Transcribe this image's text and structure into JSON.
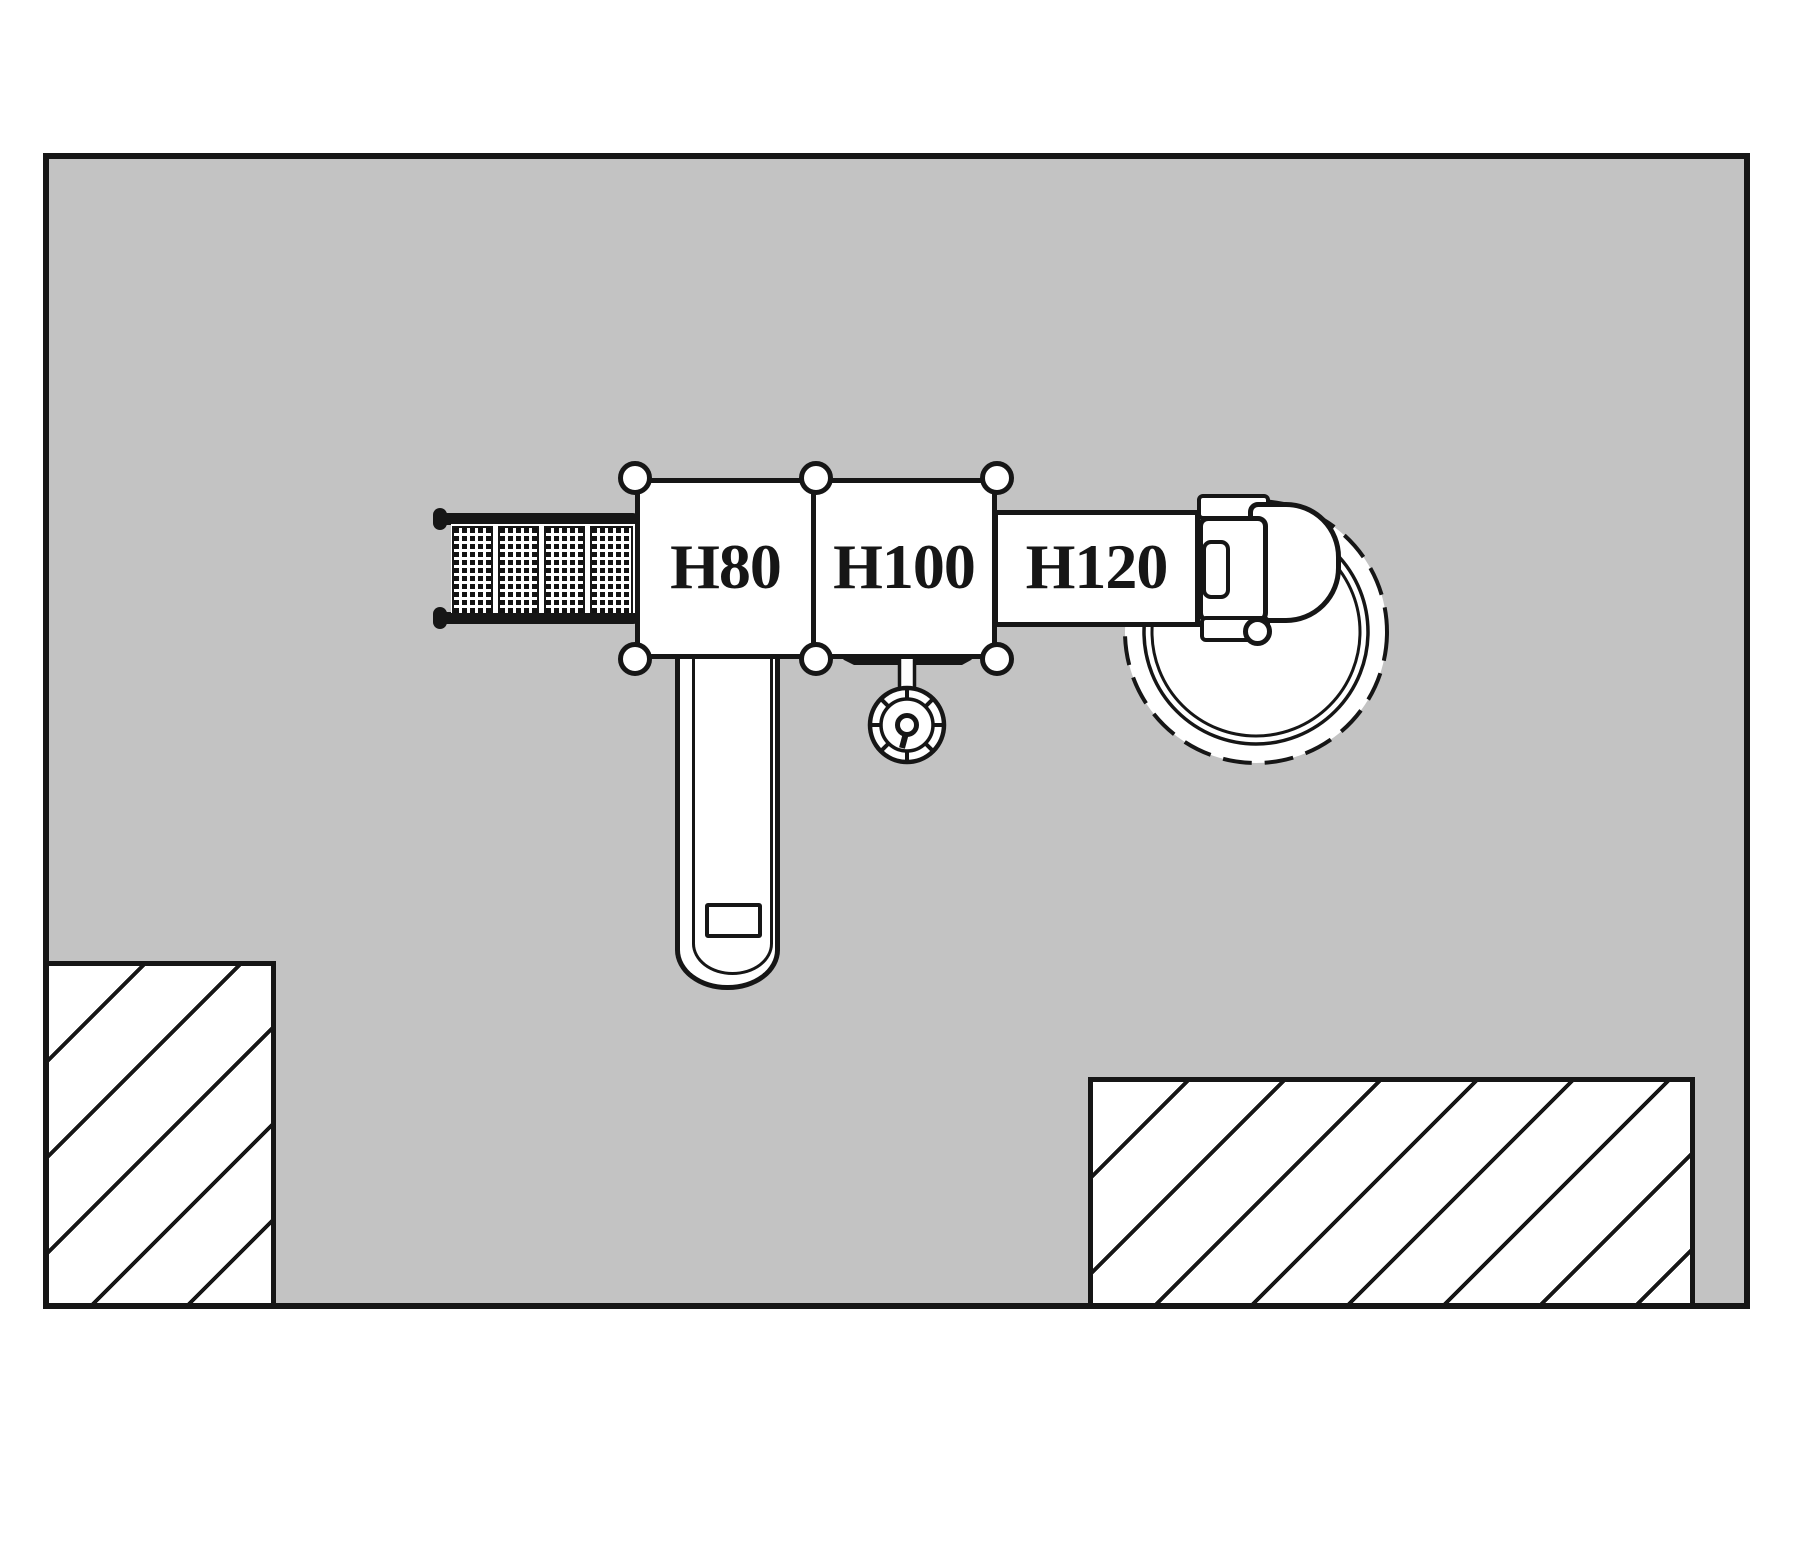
{
  "drawing": {
    "kind": "playground-equipment-plan-view",
    "platform_labels": [
      "H80",
      "H100",
      "H120"
    ],
    "colors": {
      "site_fill": "#c3c3c3",
      "line": "#161616",
      "background": "#ffffff"
    }
  },
  "components": {
    "site_area": "surfacing-area",
    "net_bridge": "net-climber-bridge",
    "platform_1": "platform-H80",
    "platform_2": "platform-H100",
    "bridge_band": "ramp-H120",
    "straight_slide": "straight-slide",
    "spiral_slide": "spiral-slide-circle",
    "hand_wheel": "pole-with-wheel",
    "hatch_zone_left": "hatched-cutout-left",
    "hatch_zone_right": "hatched-cutout-right"
  }
}
